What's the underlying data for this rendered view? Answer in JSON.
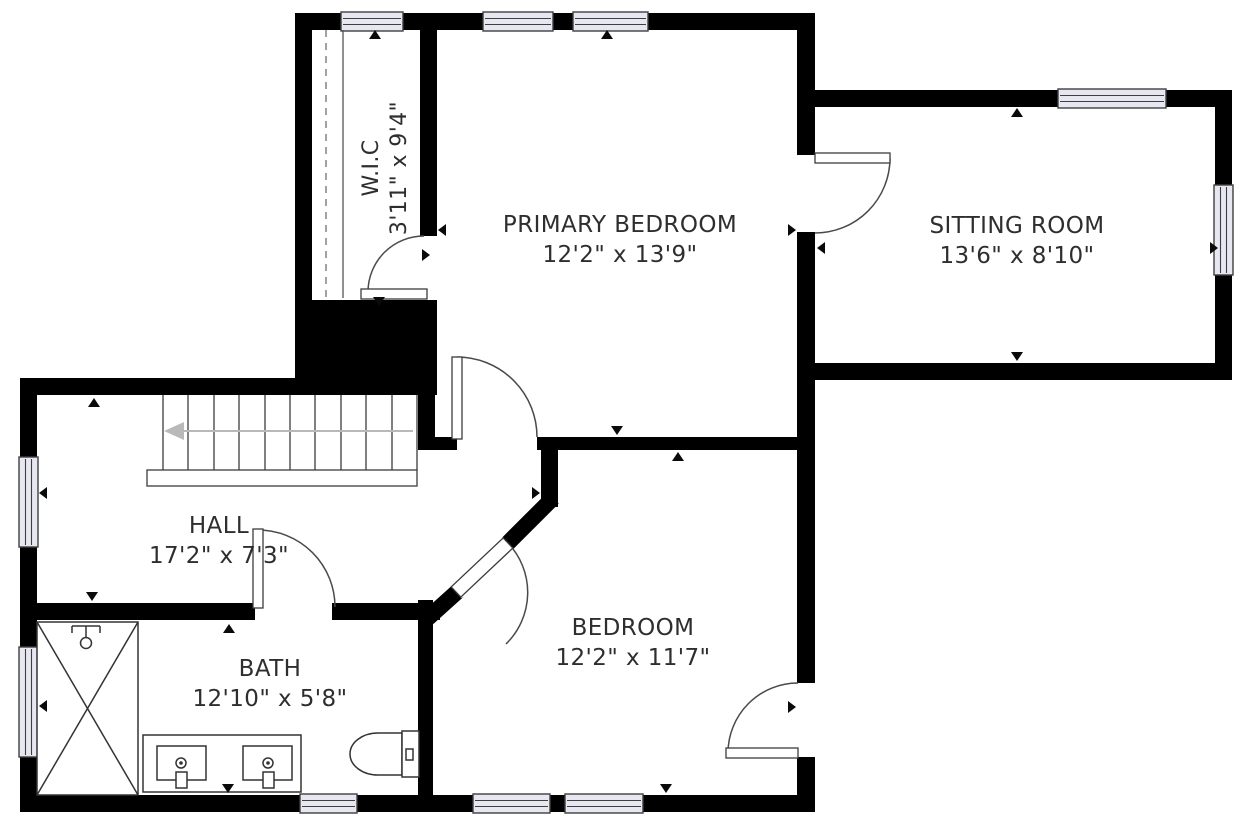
{
  "plan": {
    "type": "floor-plan",
    "rooms": [
      {
        "id": "wic",
        "name": "W.I.C",
        "dims": "3'11\" x 9'4\""
      },
      {
        "id": "primary-bedroom",
        "name": "PRIMARY BEDROOM",
        "dims": "12'2\" x 13'9\""
      },
      {
        "id": "sitting-room",
        "name": "SITTING ROOM",
        "dims": "13'6\" x 8'10\""
      },
      {
        "id": "hall",
        "name": "HALL",
        "dims": "17'2\" x 7'3\""
      },
      {
        "id": "bedroom",
        "name": "BEDROOM",
        "dims": "12'2\" x 11'7\""
      },
      {
        "id": "bath",
        "name": "BATH",
        "dims": "12'10\" x 5'8\""
      }
    ],
    "colors": {
      "wall": "#000000",
      "window_fill": "#e7e7f2",
      "label_text": "#2e2e2e",
      "stair_arrow": "#b9b9b9",
      "background": "#ffffff"
    },
    "fixtures": [
      "stairs",
      "shower",
      "double-vanity",
      "toilet",
      "closet-rod"
    ],
    "window_count": 10,
    "door_count": 6
  }
}
